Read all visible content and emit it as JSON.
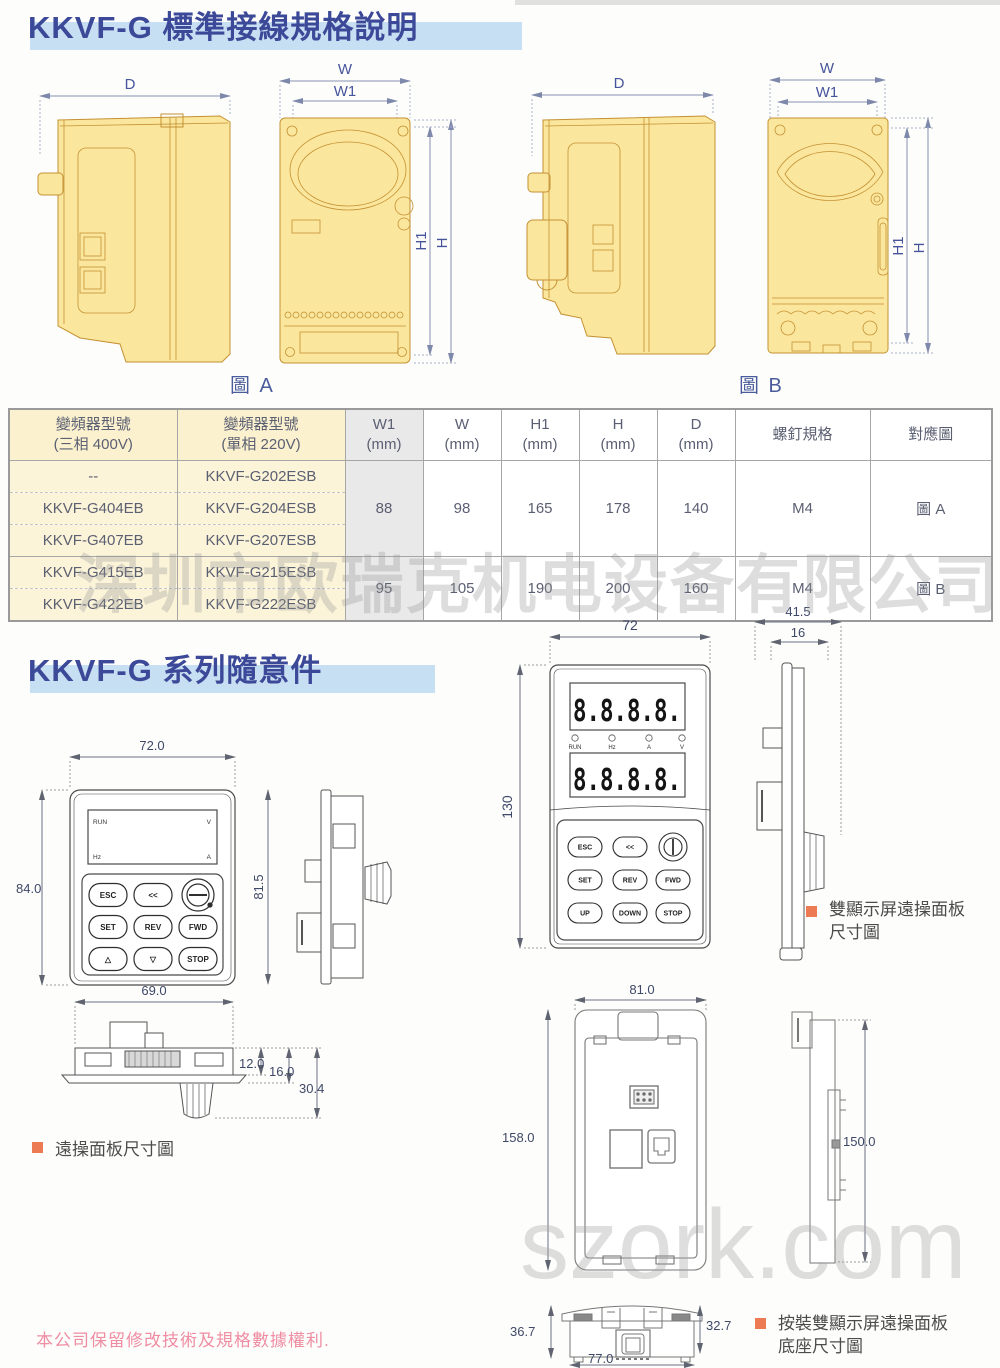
{
  "colors": {
    "title_text": "#3c4998",
    "title_bar": "#c7dff2",
    "drawing_fill": "#fbe69d",
    "drawing_outline": "#c49133",
    "dim_line": "#8791b3",
    "accent_square": "#ec7a52",
    "note_pink": "#ef8da2",
    "table_cream": "#fbf1cf",
    "watermark_gray": "#d7d7d7"
  },
  "sections": {
    "s1_title": "KKVF-G 標準接線規格說明",
    "s2_title": "KKVF-G 系列隨意件"
  },
  "figures": {
    "a": {
      "caption": "圖 A",
      "dim_d": "D",
      "dim_w": "W",
      "dim_w1": "W1",
      "dim_h1": "H1",
      "dim_h": "H"
    },
    "b": {
      "caption": "圖 B",
      "dim_d": "D",
      "dim_w": "W",
      "dim_w1": "W1",
      "dim_h1": "H1",
      "dim_h": "H"
    }
  },
  "spec_table": {
    "col_model400_l1": "變頻器型號",
    "col_model400_l2": "(三相 400V)",
    "col_model220_l1": "變頻器型號",
    "col_model220_l2": "(單相 220V)",
    "col_w1_l1": "W1",
    "col_w1_l2": "(mm)",
    "col_w_l1": "W",
    "col_w_l2": "(mm)",
    "col_h1_l1": "H1",
    "col_h1_l2": "(mm)",
    "col_h_l1": "H",
    "col_h_l2": "(mm)",
    "col_d_l1": "D",
    "col_d_l2": "(mm)",
    "col_screw": "螺釘規格",
    "col_fig": "對應圖",
    "rows": [
      {
        "m400": "--",
        "m220": "KKVF-G202ESB"
      },
      {
        "m400": "KKVF-G404EB",
        "m220": "KKVF-G204ESB"
      },
      {
        "m400": "KKVF-G407EB",
        "m220": "KKVF-G207ESB"
      },
      {
        "m400": "KKVF-G415EB",
        "m220": "KKVF-G215ESB"
      },
      {
        "m400": "KKVF-G422EB",
        "m220": "KKVF-G222ESB"
      }
    ],
    "groupA": {
      "w1": "88",
      "w": "98",
      "h1": "165",
      "h": "178",
      "d": "140",
      "screw": "M4",
      "fig": "圖 A"
    },
    "groupB": {
      "w1": "95",
      "w": "105",
      "h1": "190",
      "h": "200",
      "d": "160",
      "screw": "M4",
      "fig": "圖 B"
    }
  },
  "remote": {
    "dims": {
      "top": "72.0",
      "left": "84.0",
      "side": "81.5",
      "bottom": "69.0",
      "p1": "12.0",
      "p2": "16.0",
      "p3": "30.4"
    },
    "display": {
      "run": "RUN",
      "hz": "Hz",
      "v": "V",
      "a": "A"
    },
    "buttons": {
      "esc": "ESC",
      "back": "<<",
      "set": "SET",
      "rev": "REV",
      "fwd": "FWD",
      "up": "△",
      "down": "▽",
      "stop": "STOP"
    },
    "label": "遠操面板尺寸圖"
  },
  "dual": {
    "dims": {
      "top": "72",
      "left": "130",
      "side_w": "41.5",
      "side_w1": "16"
    },
    "display_value": "8.8.8.8.",
    "indicators": {
      "run": "RUN",
      "hz": "Hz",
      "a": "A",
      "v": "V"
    },
    "buttons": {
      "esc": "ESC",
      "back": "<<",
      "set": "SET",
      "rev": "REV",
      "fwd": "FWD",
      "up": "UP",
      "down": "DOWN",
      "stop": "STOP"
    },
    "label_l1": "雙顯示屏遠操面板",
    "label_l2": "尺寸圖"
  },
  "base": {
    "dims": {
      "top": "81.0",
      "left": "158.0",
      "side": "150.0",
      "bl": "36.7",
      "br": "32.7",
      "bottom": "77.0"
    },
    "label_l1": "按裝雙顯示屏遠操面板",
    "label_l2": "底座尺寸圖"
  },
  "watermarks": {
    "company": "深圳市欧瑞克机电设备有限公司",
    "site": "szork.com"
  },
  "footer_note": "本公司保留修改技術及規格數據權利."
}
